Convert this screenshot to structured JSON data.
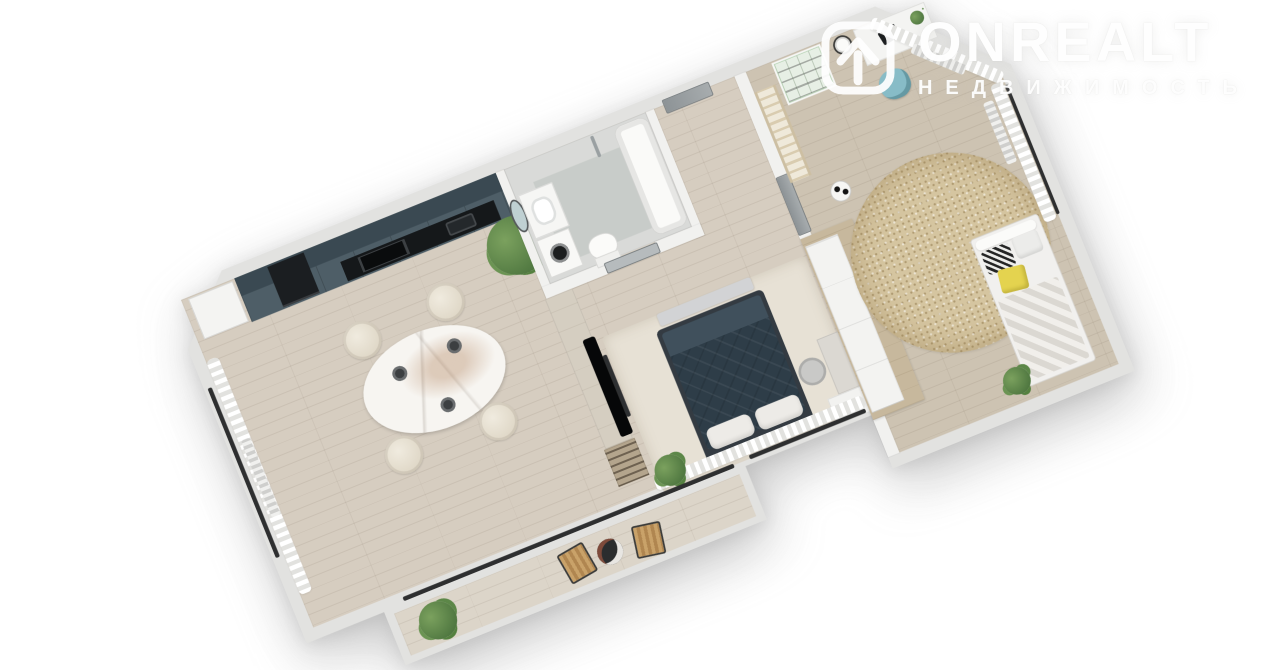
{
  "watermark": {
    "brand": "ONREALT",
    "tagline": "НЕДВИЖИМОСТЬ",
    "icon": "onrealt-house-icon"
  },
  "scene": {
    "type": "3d-floor-plan-render",
    "description": "Photorealistic top-down 3D render of a one-bedroom apartment rotated diagonally on a white background",
    "rooms": [
      {
        "name": "kitchen-dining",
        "furniture": [
          "dark teal cabinet run with black counter and oven",
          "white fridge",
          "oval marble dining table with place settings",
          "four cream chairs",
          "large potted plant",
          "window curtain",
          "radiator"
        ]
      },
      {
        "name": "bathroom",
        "furniture": [
          "oval mirror",
          "washbasin vanity",
          "washing machine",
          "toilet",
          "bathtub",
          "shower fixture"
        ]
      },
      {
        "name": "hallway",
        "furniture": [
          "entry door",
          "gray door to kids room"
        ]
      },
      {
        "name": "bedroom-living",
        "furniture": [
          "tv partition with tv and soundbar",
          "bookshelf",
          "double bed with dark blue quilt",
          "bench",
          "light area rug",
          "vanity desk with chair",
          "white cabinet",
          "sheer ruffled curtains",
          "potted plant"
        ]
      },
      {
        "name": "kids-room",
        "furniture": [
          "swedish wall bars",
          "green shelving unit",
          "wall clock",
          "white desk with laptop",
          "blue desk chair",
          "round jute rug",
          "soccer ball",
          "bed with knit blanket and yellow and black pillows",
          "curtains",
          "radiators",
          "wardrobe row with wooden top"
        ]
      },
      {
        "name": "balcony",
        "furniture": [
          "two wooden folding chairs",
          "black coffee table with plates",
          "potted plant"
        ]
      }
    ]
  },
  "palette": {
    "background": "#ffffff",
    "wall": "#e2e2e0",
    "floor_wood": "#d6cdc0",
    "kitchen_cabinet": "#4e5e67",
    "kitchen_upper": "#3a4952",
    "counter_black": "#15181a",
    "bed_duvet": "#2e3d48",
    "kids_rug": "#d5c5a0",
    "accent_yellow": "#e4d34f",
    "accent_blue": "#87bcc7",
    "plant_green": "#4f7740",
    "logo_white": "#ffffff"
  }
}
